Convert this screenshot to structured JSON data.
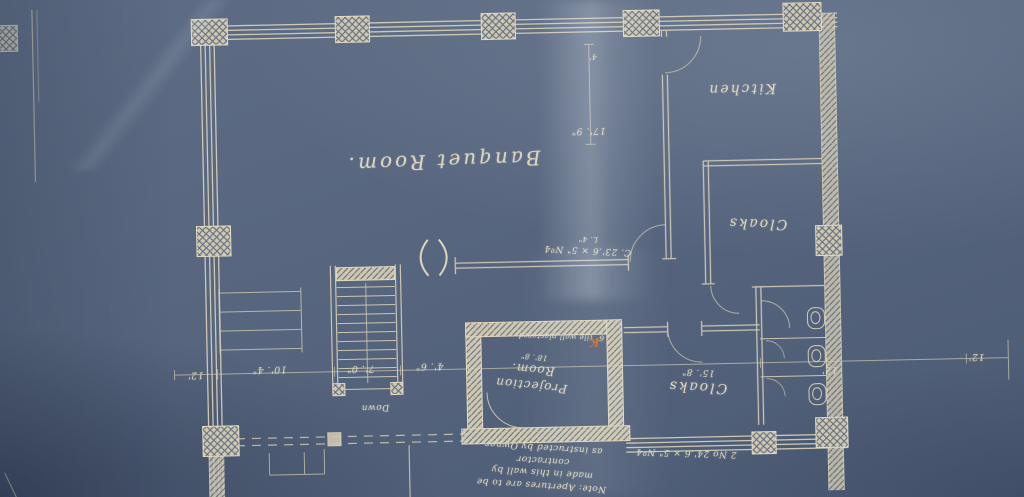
{
  "colors": {
    "paper_blue": "#57667e",
    "line_cream": "#d8d0b8",
    "ink_cream": "#ddd6bf",
    "red_mark": "#c06a34"
  },
  "rooms": {
    "banquet": "Banquet Room.",
    "kitchen": "Kitchen",
    "cloaks_upper": "Cloaks",
    "cloaks_lower": "Cloaks",
    "cloaks_lower_dim": "15'. 8\"",
    "projection_line1": "Projection",
    "projection_line2": "Room.",
    "projection_dim": "18'. 8\""
  },
  "annotations": {
    "down": "Down",
    "beam_upper_main": "C. 23'.6 × 5\" Nº4",
    "beam_upper_sub": "L. 4\"",
    "beam_lower": "2 No 24'.6 × 5\" Nº4",
    "wall_note": "6\" tile wall plastered.",
    "wall_note_mark": "K",
    "aperture_note": [
      "Note: Apertures are to be",
      "made in this wall by contractor",
      "as instructed by Owner"
    ]
  },
  "dimensions": {
    "d17_9": "17'. 9\"",
    "d4_top": "4'",
    "d12_left": "12'",
    "d10_4": "10'. 4\"",
    "d7_0": "7'. 0\"",
    "d4_6": "4'. 6\"",
    "d12_right": "12'",
    "d12_far_right": "12'"
  }
}
